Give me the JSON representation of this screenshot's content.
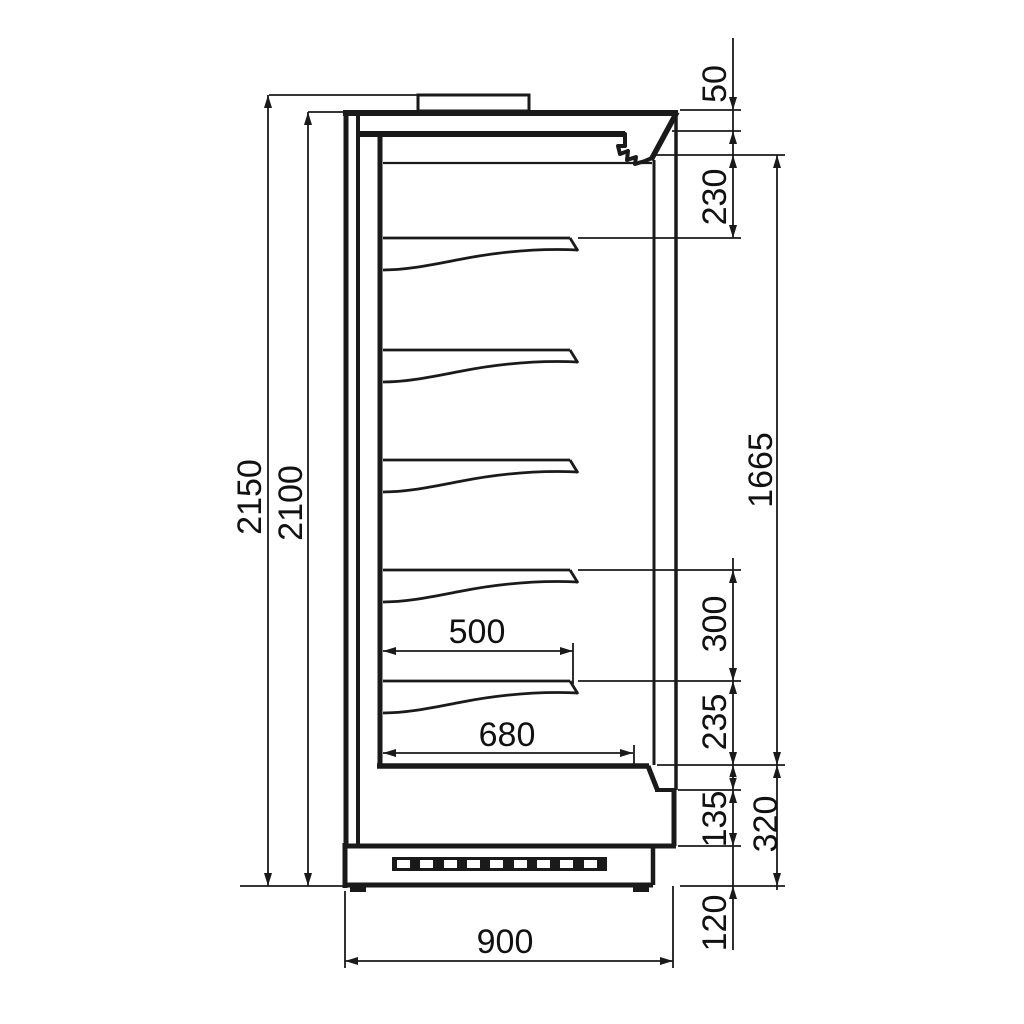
{
  "colors": {
    "ink": "#1a1a1a",
    "paper": "#ffffff"
  },
  "dimensions": {
    "overall_height": "2150",
    "body_height": "2100",
    "canopy_height": "50",
    "top_clearance": "230",
    "display_opening_height": "1665",
    "shelf_spacing": "300",
    "bottom_shelf_clearance": "235",
    "kick_height": "135",
    "base_section_height": "320",
    "foot_clearance": "120",
    "shelf_depth": "500",
    "lower_deck_depth": "680",
    "overall_depth": "900"
  }
}
